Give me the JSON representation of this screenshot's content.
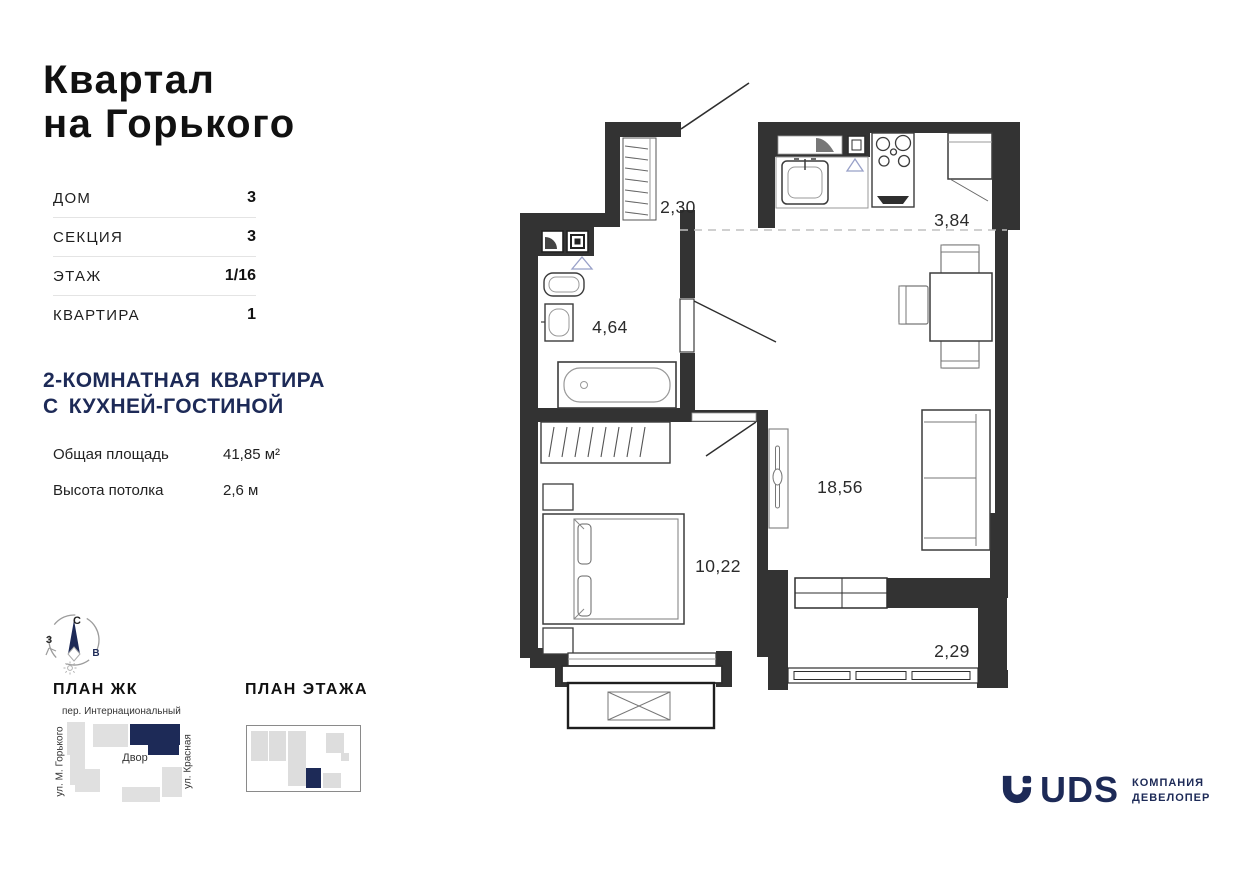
{
  "brand": {
    "line1": "Квартал",
    "line2": "на Горького"
  },
  "info_table": {
    "rows": [
      {
        "label": "ДОМ",
        "value": "3"
      },
      {
        "label": "СЕКЦИЯ",
        "value": "3"
      },
      {
        "label": "ЭТАЖ",
        "value": "1/16"
      },
      {
        "label": "КВАРТИРА",
        "value": "1"
      }
    ]
  },
  "apartment": {
    "title_line1": "2-КОМНАТНАЯ КВАРТИРА",
    "title_line2": "С КУХНЕЙ-ГОСТИНОЙ",
    "specs": [
      {
        "label": "Общая площадь",
        "value": "41,85 м²"
      },
      {
        "label": "Высота потолка",
        "value": "2,6 м"
      }
    ]
  },
  "compass": {
    "north": "С",
    "west": "З",
    "east": "В"
  },
  "plan_jk": {
    "title": "ПЛАН ЖК",
    "street_top": "пер. Интернациональный",
    "street_left": "ул. М. Горького",
    "street_right": "ул. Красная",
    "courtyard": "Двор"
  },
  "plan_floor": {
    "title": "ПЛАН ЭТАЖА"
  },
  "floor_plan": {
    "rooms": [
      {
        "name": "hallway",
        "area": "2,30"
      },
      {
        "name": "kitchen",
        "area": "3,84"
      },
      {
        "name": "bathroom",
        "area": "4,64"
      },
      {
        "name": "living-room",
        "area": "18,56"
      },
      {
        "name": "bedroom",
        "area": "10,22"
      },
      {
        "name": "balcony",
        "area": "2,29"
      }
    ]
  },
  "logo": {
    "name": "UDS",
    "tagline_line1": "КОМПАНИЯ",
    "tagline_line2": "ДЕВЕЛОПЕР"
  },
  "colors": {
    "navy": "#1d2a57",
    "wall": "#333333",
    "block_gray": "#e0e0e0"
  }
}
